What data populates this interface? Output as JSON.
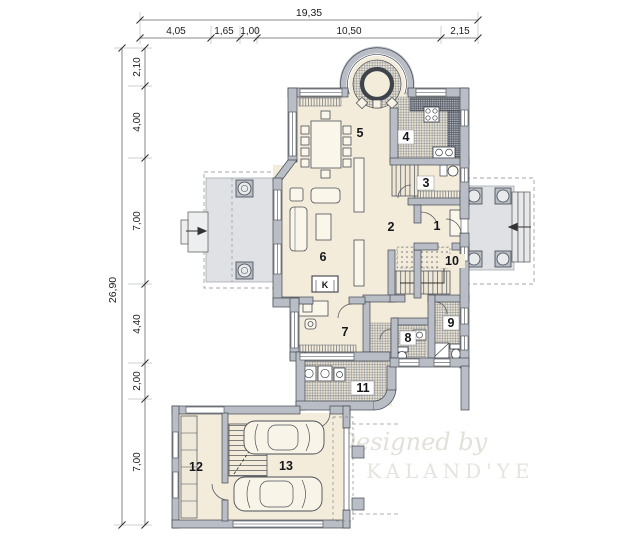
{
  "plan": {
    "type": "architectural-floor-plan",
    "fireplace_label": "K"
  },
  "dimensions": {
    "top": {
      "total": "19,35",
      "segments": [
        "4,05",
        "1,65",
        "1,00",
        "10,50",
        "2,15"
      ]
    },
    "left": {
      "total": "26,90",
      "segments": [
        "2,10",
        "4,00",
        "7,00",
        "4,40",
        "2,00",
        "7,00"
      ]
    }
  },
  "rooms": [
    {
      "number": "1"
    },
    {
      "number": "2"
    },
    {
      "number": "3"
    },
    {
      "number": "4"
    },
    {
      "number": "5"
    },
    {
      "number": "6"
    },
    {
      "number": "7"
    },
    {
      "number": "8"
    },
    {
      "number": "9"
    },
    {
      "number": "10"
    },
    {
      "number": "11"
    },
    {
      "number": "12"
    },
    {
      "number": "13"
    }
  ],
  "watermark": {
    "line1": "Designed by",
    "line2": "MK KALAND'YE"
  },
  "colors": {
    "wall": "#b8bdc6",
    "wall_outline": "#43474e",
    "floor": "#f3ecdb",
    "terrace": "#dfe1e4",
    "hatch_line": "#8a9098",
    "dimension_line": "#666666",
    "watermark": "#e7e4df"
  }
}
